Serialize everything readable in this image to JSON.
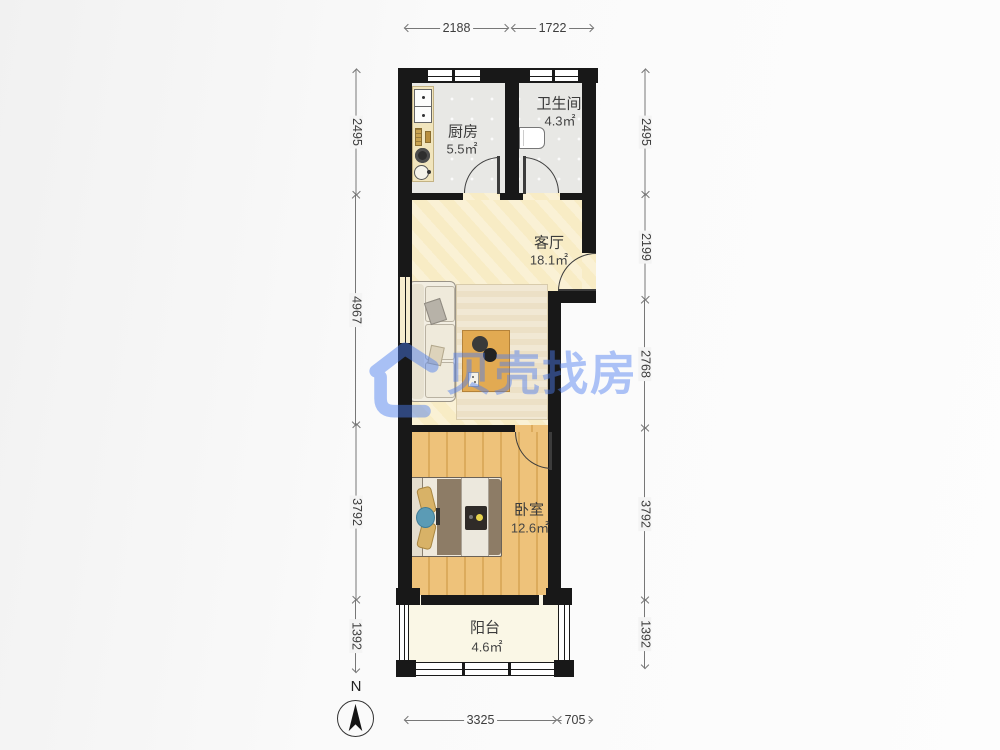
{
  "rooms": {
    "kitchen": {
      "name": "厨房",
      "area": "5.5㎡"
    },
    "bathroom": {
      "name": "卫生间",
      "area": "4.3㎡"
    },
    "living": {
      "name": "客厅",
      "area": "18.1㎡"
    },
    "bedroom": {
      "name": "卧室",
      "area": "12.6㎡"
    },
    "balcony": {
      "name": "阳台",
      "area": "4.6㎡"
    }
  },
  "dimensions": {
    "top": [
      "2188",
      "1722"
    ],
    "left": [
      "2495",
      "4967",
      "3792",
      "1392"
    ],
    "right": [
      "2495",
      "2199",
      "2768",
      "3792",
      "1392"
    ],
    "bottom": [
      "3325",
      "705"
    ]
  },
  "watermark": {
    "text": "贝壳找房",
    "brand_color": "#4a7df0"
  },
  "compass": {
    "label": "N"
  },
  "colors": {
    "wall": "#181818",
    "tile_floor": "#e8e8e5",
    "living_floor": "#f8ecc5",
    "wood_floor": "#eec27a",
    "balcony_floor": "#faf7e6",
    "dimension_line": "#777777"
  }
}
